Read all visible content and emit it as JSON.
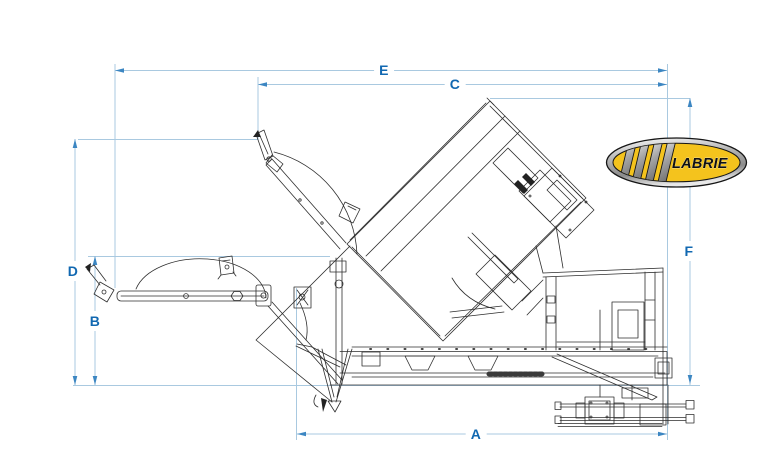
{
  "window": {
    "width": 768,
    "height": 461,
    "background": "#ffffff"
  },
  "diagram": {
    "description": "Technical side-elevation line drawing of a Labrie automated side-loader arm mechanism shown in raised (dump) and lowered (reach) positions, with dimension callouts",
    "dimensions": {
      "A": {
        "label": "A"
      },
      "B": {
        "label": "B"
      },
      "C": {
        "label": "C"
      },
      "D": {
        "label": "D"
      },
      "E": {
        "label": "E"
      },
      "F": {
        "label": "F"
      }
    },
    "colors": {
      "dimension_line": "#a9c9e0",
      "dimension_arrow": "#3c86c2",
      "dimension_label": "#1168b1",
      "drawing_line": "#2e2e2e",
      "ground_reference_line": "#a9c9e0"
    }
  },
  "logo": {
    "text": "LABRIE",
    "colors": {
      "badge_yellow": "#f4c31d",
      "chrome": "#b9b9b9",
      "ring": "#161616",
      "text": "#101010"
    }
  }
}
